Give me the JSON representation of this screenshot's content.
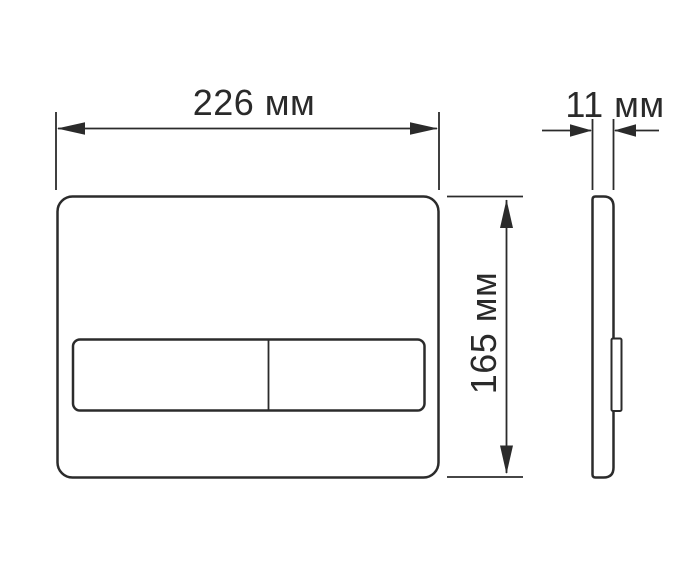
{
  "diagram": {
    "type": "technical-dimension-drawing",
    "subject": "flush plate with two buttons, front and side views",
    "dimensions": {
      "width": {
        "label": "226 мм",
        "value": 226,
        "unit": "мм"
      },
      "height": {
        "label": "165 мм",
        "value": 165,
        "unit": "мм"
      },
      "depth": {
        "label": "11 мм",
        "value": 11,
        "unit": "мм"
      }
    },
    "colors": {
      "line": "#2b2b2b",
      "text": "#2a2a2a",
      "background": "#ffffff"
    }
  }
}
